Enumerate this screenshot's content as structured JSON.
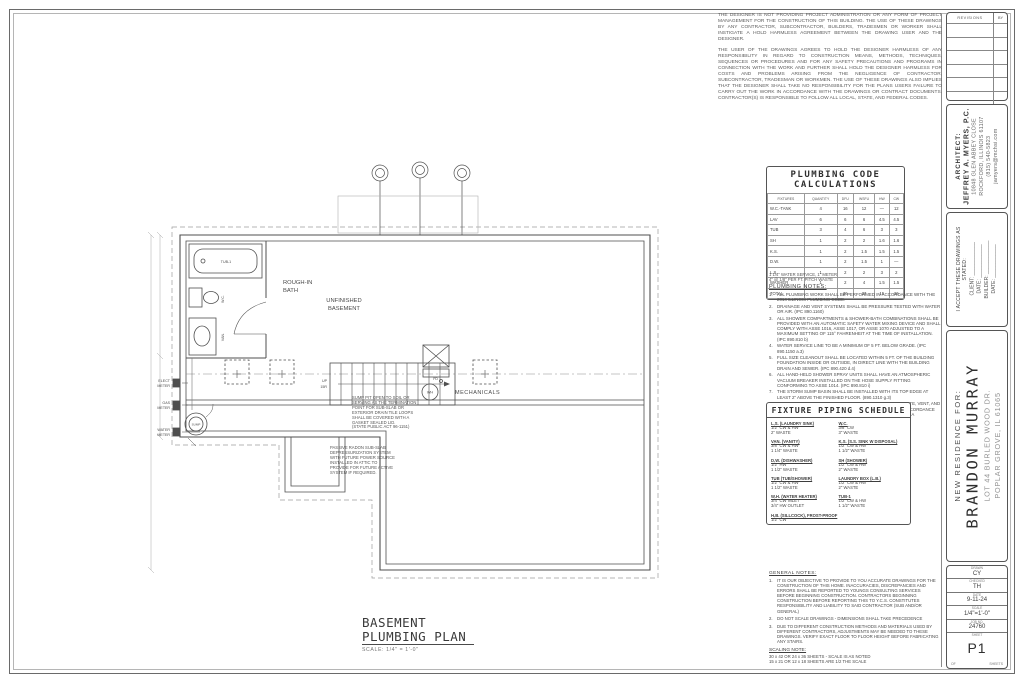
{
  "disclaimer": {
    "p1": "THE DESIGNER IS NOT PROVIDING PROJECT ADMINISTRATION OR ANY FORM OF PROJECT MANAGEMENT FOR THE CONSTRUCTION OF THIS BUILDING. THE USE OF THESE DRAWINGS BY ANY CONTRACTOR, SUBCONTRACTOR, BUILDERS, TRADESMEN OR WORKER SHALL INSTIGATE A HOLD HARMLESS AGREEMENT BETWEEN THE DRAWING USER AND THE DESIGNER.",
    "p2": "THE USER OF THE DRAWINGS AGREES TO HOLD THE DESIGNER HARMLESS OF ANY RESPONSIBILITY IN REGARD TO CONSTRUCTION MEANS, METHODS, TECHNIQUES, SEQUENCES OR PROCEDURES AND FOR ANY SAFETY PRECAUTIONS AND PROGRAMS IN CONNECTION WITH THE WORK AND FURTHER SHALL HOLD THE DESIGNER HARMLESS FOR COSTS AND PROBLEMS ARISING FROM THE NEGLIGENCE OF CONTRACTOR, SUBCONTRACTOR, TRADESMAN OR WORKMEN. THE USE OF THESE DRAWINGS ALSO IMPLIES THAT THE DESIGNER SHALL TAKE NO RESPONSIBILITY FOR THE PLANS USERS FAILURE TO CARRY OUT THE WORK IN ACCORDANCE WITH THE DRAWINGS OR CONTRACT DOCUMENTS. CONTRACTOR(S) IS RESPONSIBLE TO FOLLOW ALL LOCAL, STATE, AND FEDERAL CODES."
  },
  "calc_table": {
    "title_line1": "PLUMBING CODE",
    "title_line2": "CALCULATIONS",
    "headers": [
      "FIXTURES",
      "QUANTITY",
      "DFU",
      "WSFU",
      "HW",
      "CW"
    ],
    "rows": [
      [
        "W.C.-TANK",
        "4",
        "16",
        "12",
        "—",
        "12"
      ],
      [
        "LAV",
        "6",
        "6",
        "6",
        "4.5",
        "4.5"
      ],
      [
        "TUB",
        "3",
        "4",
        "6",
        "3",
        "3"
      ],
      [
        "SH",
        "1",
        "2",
        "2",
        "1.6",
        "1.6"
      ],
      [
        "K.S.",
        "1",
        "2",
        "1.5",
        "1.5",
        "1.5"
      ],
      [
        "D.W.",
        "1",
        "2",
        "1.5",
        "1",
        "—"
      ],
      [
        "L.S.",
        "1",
        "2",
        "2",
        "3",
        "2"
      ],
      [
        "WASHER",
        "1",
        "2",
        "4",
        "1.5",
        "1.5"
      ],
      [
        "TOTAL",
        "",
        "36",
        "37",
        "15",
        "26"
      ]
    ],
    "footnotes": [
      "1 1/4\" WATER SERVICE, 1\" METER",
      "4\" @ 1/8\" PER FT. PITCH WASTE"
    ]
  },
  "plumbing_notes": {
    "title": "PLUMBING NOTES:",
    "items": [
      "ALL PLUMBING WORK SHALL BE PERFORMED IN ACCORDANCE WITH THE 2014 ILLINOIS PLUMBING CODE.",
      "DRAINAGE AND VENT SYSTEMS SHALL BE PRESSURE TESTED WITH WATER OR AIR. (IPC 890.1160)",
      "ALL SHOWER COMPARTMENTS & SHOWER-BATH COMBINATIONS SHALL BE PROVIDED WITH AN AUTOMATIC SAFETY WATER MIXING DEVICE AND SHALL COMPLY WITH ASSE 1016, ASSE 1017, OR ASSE 1070 ADJUSTED TO A MAXIMUM SETTING OF 115° FAHRENHEIT AT THE TIME OF INSTALLATION. (IPC 890.810 b)",
      "WATER SERVICE LINE TO BE A MINIMUM OF 5 FT. BELOW GRADE. (IPC 890.1150 a.3)",
      "FULL SIZE CLEANOUT SHALL BE LOCATED WITHIN 5 FT. OF THE BUILDING FOUNDATION INSIDE OR OUTSIDE, IN DIRECT LINE WITH THE BUILDING DRAIN AND SEWER. (IPC 890.420 d.4)",
      "ALL HAND-HELD SHOWER SPRAY UNITS SHALL HAVE AN ATMOSPHERIC VACUUM BREAKER INSTALLED ON THE HOSE SUPPLY FITTING CONFORMING TO ASSE 1014. (IPC 890.810 i)",
      "THE STORM SUMP BASIN SHALL BE INSTALLED WITH ITS TOP EDGE AT LEAST 2\" ABOVE THE FINISHED FLOOR. (890.1310 g.3)",
      "PLUMBING INSPECTOR SHALL FIELD VERIFY THE DRAIN, WASTE, VENT, AND WATER DISTRIBUTION SYSTEM TO BE PROPERLY SIZED IN ACCORDANCE WITH THE APPROPRIATE TABLES FOUND IN IPC 890 APPENDIX A"
    ]
  },
  "fixture_schedule": {
    "title": "FIXTURE PIPING SCHEDULE",
    "left": [
      {
        "name": "L.S. (LAUNDRY SINK)",
        "lines": [
          "1/2\" CW & HW",
          "2\" WASTE"
        ]
      },
      {
        "name": "VAN. (VANITY)",
        "lines": [
          "3/8\" CW & HW",
          "1 1/4\" WASTE"
        ]
      },
      {
        "name": "D.W. (DISHWASHER)",
        "lines": [
          "1/2\" HW",
          "1 1/2\" WASTE"
        ]
      },
      {
        "name": "TUB (TUB/SHOWER)",
        "lines": [
          "1/2\" CW & HW",
          "1 1/2\" WASTE"
        ]
      },
      {
        "name": "W.H. (WATER HEATER)",
        "lines": [
          "3/4\" CW INLET",
          "3/4\" HW OUTLET"
        ]
      },
      {
        "name": "H.B. (SILLCOCK), FROST-PROOF",
        "lines": [
          "1/2\" CW"
        ]
      }
    ],
    "right": [
      {
        "name": "W.C.",
        "lines": [
          "3/8\" CW",
          "3\" WASTE"
        ]
      },
      {
        "name": "K.S. (S.S. SINK W DISPOSAL)",
        "lines": [
          "1/2\" CW & HW",
          "1 1/2\" WASTE"
        ]
      },
      {
        "name": "SH (SHOWER)",
        "lines": [
          "1/2\" CW & HW",
          "2\" WASTE"
        ]
      },
      {
        "name": "LAUNDRY BOX (L.B.)",
        "lines": [
          "1/2\" CW & HW",
          "2\" WASTE"
        ]
      },
      {
        "name": "TUB-1",
        "lines": [
          "1/2\" CW & HW",
          "1 1/2\" WASTE"
        ]
      }
    ]
  },
  "general_notes": {
    "title": "GENERAL NOTES:",
    "items": [
      "IT IS OUR OBJECTIVE TO PROVIDE TO YOU ACCURATE DRAWINGS FOR THE CONSTRUCTION OF THIS HOME. INACCURACIES, DISCREPANCIES AND ERRORS SHALL BE REPORTED TO YOUNGS CONSULTING SERVICES BEFORE BEGINNING CONSTRUCTION. CONTRACTORS BEGINNING CONSTRUCTION BEFORE REPORTING THIS TO Y.C.S. CONSTITUTES RESPONSIBILITY AND LIABILITY TO SAID CONTRACTOR (SUB AND/OR GENERAL)",
      "DO NOT SCALE DRAWINGS - DIMENSIONS SHALL TAKE PRECEDENCE",
      "DUE TO DIFFERENT CONSTRUCTION METHODS AND MATERIALS USED BY DIFFERENT CONTRACTORS, ADJUSTMENTS MAY BE NEEDED TO THESE DRAWINGS. VERIFY EXACT FLOOR TO FLOOR HEIGHT BEFORE FABRICATING ANY STAIRS."
    ]
  },
  "scaling_note": {
    "title": "SCALING NOTE:",
    "lines": [
      "30 x 42 OR 24 x 36 SHEETS - SCALE IS AS NOTED",
      "15 x 21 OR 12 x 18 SHEETS ARE 1/2 THE SCALE"
    ]
  },
  "plan": {
    "labels": {
      "rough_in_bath_1": "ROUGH-IN",
      "rough_in_bath_2": "BATH",
      "unfinished_1": "UNFINISHED",
      "unfinished_2": "BASEMENT",
      "mechanicals": "MECHANICALS",
      "tub": "TUB-1",
      "wc": "W.C.",
      "van": "VAN.",
      "sump": "SUMP",
      "wh": "WH",
      "fd": "FD",
      "up": "UP",
      "risers": "15R",
      "elect_meter_1": "ELECT",
      "elect_meter_2": "METER",
      "gas_meter_1": "GAS",
      "gas_meter_2": "METER",
      "water_meter_1": "WATER",
      "water_meter_2": "METER"
    },
    "sump_note": [
      "SUMP PIT OPEN TO SOIL OR",
      "SERVING AS THE TERMINATION",
      "POINT FOR SUB-SLAB OR",
      "EXTERIOR DRAIN TILE LOOPS",
      "SHALL BE COVERED WITH A",
      "GASKET SEALED LID.",
      "(STATE PUBLIC ACT 96-1151)"
    ],
    "radon_note": [
      "PASSIVE RADON SUB-SLAB",
      "DEPRESSURIZATION SYSTEM",
      "WITH FUTURE POWER SOURCE",
      "INSTALLED IN ATTIC TO",
      "PROVIDE FOR FUTURE ACTIVE",
      "SYSTEM IF REQUIRED."
    ]
  },
  "plan_title": {
    "line1": "BASEMENT",
    "line2": "PLUMBING PLAN",
    "scale": "SCALE: 1/4\" = 1'-0\""
  },
  "title_block": {
    "revisions": {
      "header": "REVISIONS",
      "by": "BY",
      "empty_rows": 6
    },
    "architect": {
      "lines": [
        "ARCHITECT:",
        "JEFFREY A. MYERS, P.C.",
        "10848 GLEN ABBEY CLOSE",
        "ROCKFORD, ILLINOIS 61107",
        "(815) 540-5823",
        "jamyers@mchsi.com"
      ]
    },
    "acceptance": {
      "lines": [
        "I ACCEPT THESE DRAWINGS AS STATED:",
        "CLIENT: ____________",
        "DATE: ____________",
        "BUILDER: ____________",
        "DATE: ____________"
      ]
    },
    "project": {
      "prefix": "NEW RESIDENCE FOR:",
      "name": "BRANDON MURRAY",
      "address1": "LOT 44 BURLED WOOD DR.",
      "address2": "POPLAR GROVE, IL 61065"
    },
    "info": {
      "rows": [
        {
          "label": "DRAWN",
          "value": "CY"
        },
        {
          "label": "CHECKED",
          "value": "TH"
        },
        {
          "label": "DATE",
          "value": "9-11-24"
        },
        {
          "label": "SCALE",
          "value": "1/4\"=1'-0\""
        },
        {
          "label": "JOB NO.",
          "value": "24760"
        }
      ],
      "sheet_label": "SHEET",
      "sheet_value": "P1",
      "of_label": "OF",
      "sheets_label": "SHEETS"
    }
  },
  "colors": {
    "line": "#4f4f4f",
    "text": "#3d3d3d",
    "muted": "#8a8a8a"
  }
}
